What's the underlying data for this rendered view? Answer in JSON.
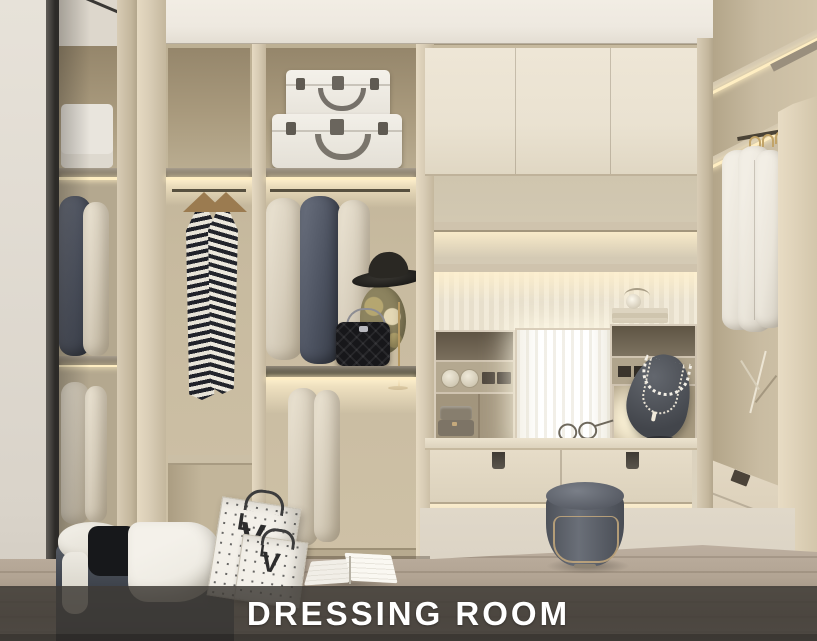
{
  "banner": {
    "caption": "DRESSING ROOM"
  },
  "monogram": {
    "letter_l": "L",
    "letter_v": "V"
  },
  "palette": {
    "ceiling": "#eee9e0",
    "wall": "#e7e2d9",
    "frame_dark": "#3c3a36",
    "wood": "#d8ccb5",
    "wood_deep": "#c4b79d",
    "interior": "#c7ba9f",
    "interior_shadow": "#95866b",
    "shelf_gray": "#847a6a",
    "led": "#ffeec2",
    "garment_navy": "#4c5260",
    "garment_beige": "#d8cfbd",
    "garment_white": "#eae5da",
    "cabinet": "#eae2d1",
    "mirror_glow": "#ffffff",
    "drawer": "#e3d9c4",
    "handle": "#453f36",
    "stool": "#575b64",
    "brass": "#c5a97c",
    "carpet": "#dbd3c4",
    "floor": "#b2a493",
    "floor_dark": "#948575",
    "bench": "#3d424b",
    "cloth_white": "#efece4",
    "cloth_black": "#17181b",
    "bag_paper": "#f3f0e9",
    "bag_print": "#383838",
    "hat": "#26241f",
    "banner_bg": "rgba(62,58,54,0.84)",
    "banner_text": "#ffffff"
  }
}
